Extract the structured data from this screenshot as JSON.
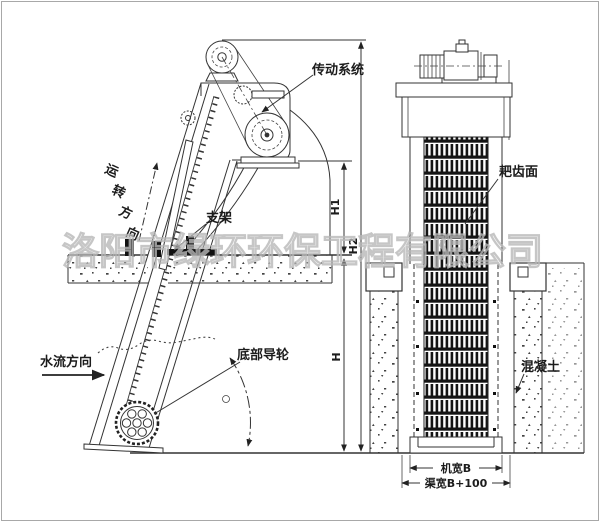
{
  "watermark": "洛阳市绿环环保工程有限公司",
  "side_view": {
    "labels": {
      "drive_system": "传动系统",
      "rotation_chars": [
        "运",
        "转",
        "方",
        "向"
      ],
      "support": "支架",
      "water_flow": "水流方向",
      "bottom_guide_wheel": "底部导轮"
    },
    "dimensions": {
      "h1": "H1",
      "h": "H",
      "h2": "H2"
    }
  },
  "front_view": {
    "labels": {
      "rake_face": "耙齿面",
      "concrete": "混凝土"
    },
    "dimensions": {
      "machine_width": "机宽B",
      "channel_width": "渠宽B+100"
    }
  },
  "colors": {
    "line": "#333333",
    "watermark": "#b9b9b9",
    "background": "#ffffff"
  }
}
